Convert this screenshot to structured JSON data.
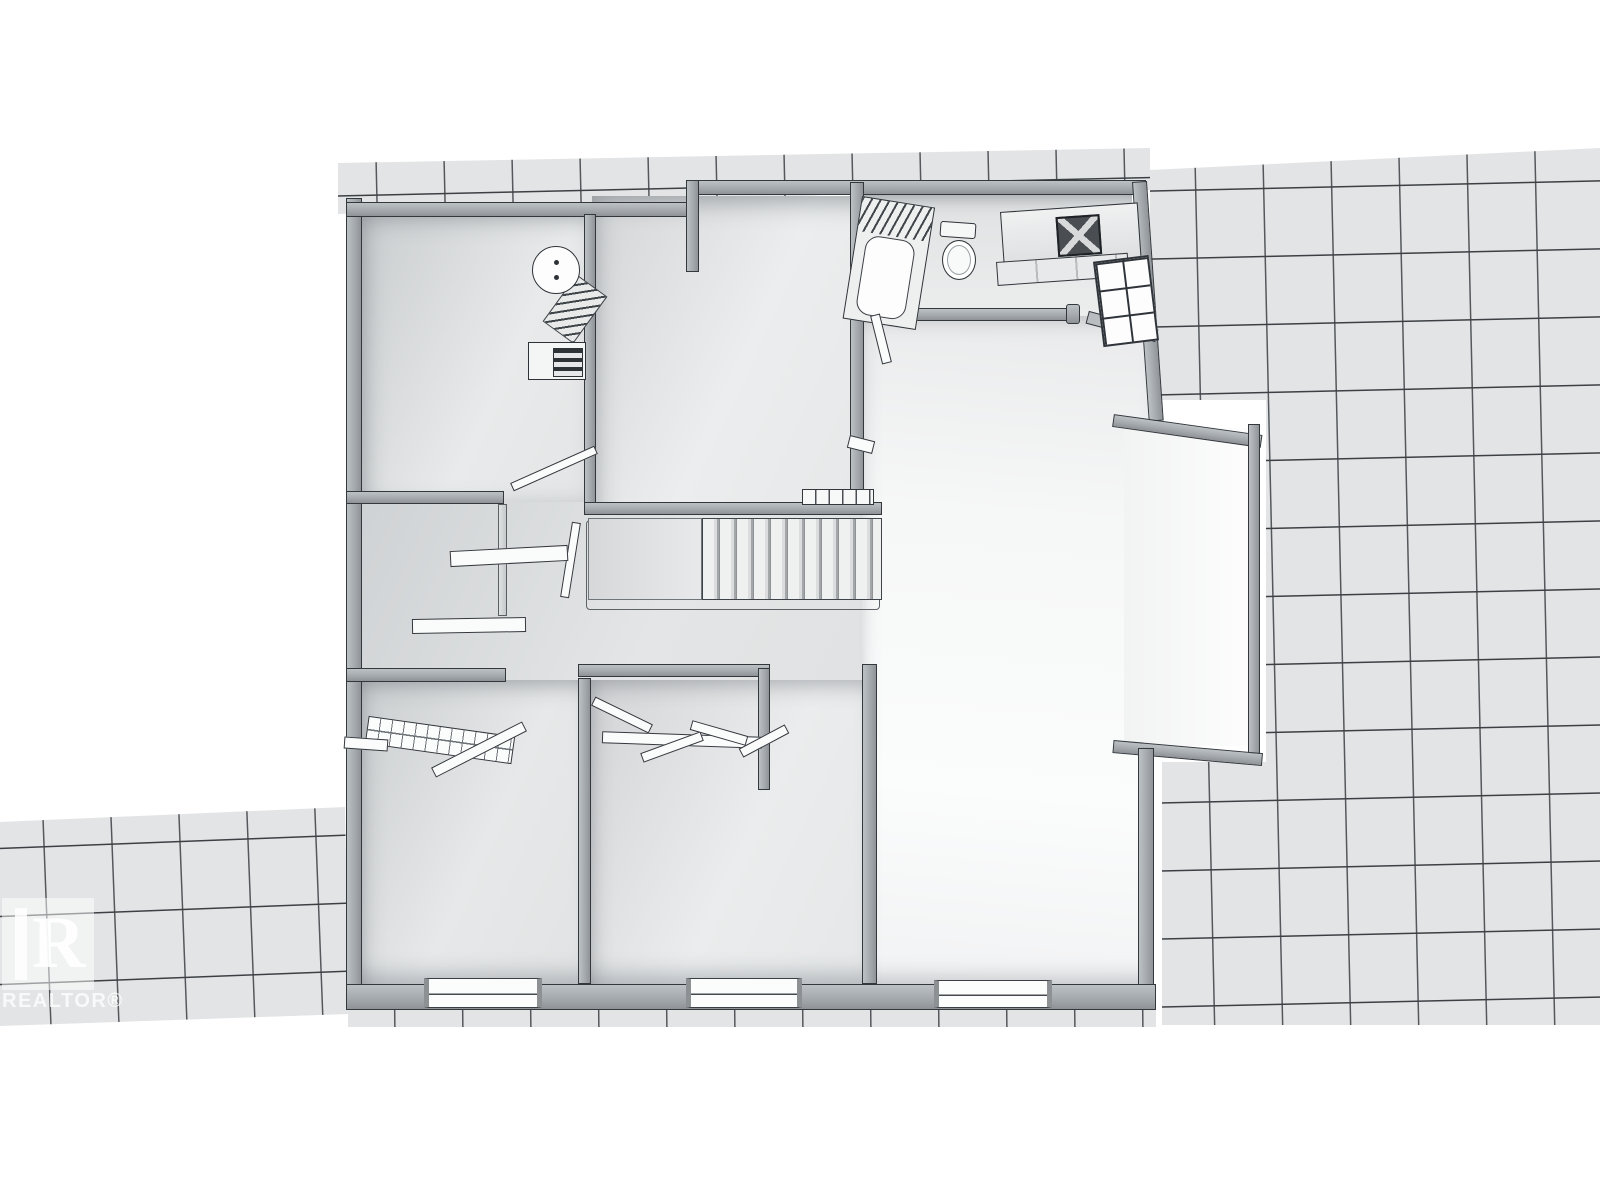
{
  "scene": {
    "description": "Grayscale 3D rendered residential floor plan viewed from above, surrounded by gridded roof tiles",
    "background_color": "#ffffff"
  },
  "palette": {
    "roof_tile_fill": "#e3e4e5",
    "roof_grid_line": "#3c4044",
    "wall_top": "#a9aeb2",
    "wall_outline": "#33383d",
    "floor_light": "#f7f8f8",
    "floor_mid": "#e7e8ea",
    "floor_shadow": "#c6c9cc"
  },
  "fixtures_visible": {
    "bathroom": [
      "bathtub",
      "toilet",
      "vanity-with-sink",
      "paned-window"
    ],
    "utility": [
      "water-heater-tank",
      "furnace"
    ],
    "circulation": [
      "staircase",
      "stair-railing",
      "open-door-leaves"
    ],
    "bedrooms": [
      "bifold-closet-doors",
      "wire-closet-shelf",
      "shelf-planks",
      "bottom-wall-windows"
    ]
  },
  "watermark": {
    "logo_letter": "R",
    "label": "REALTOR®"
  }
}
